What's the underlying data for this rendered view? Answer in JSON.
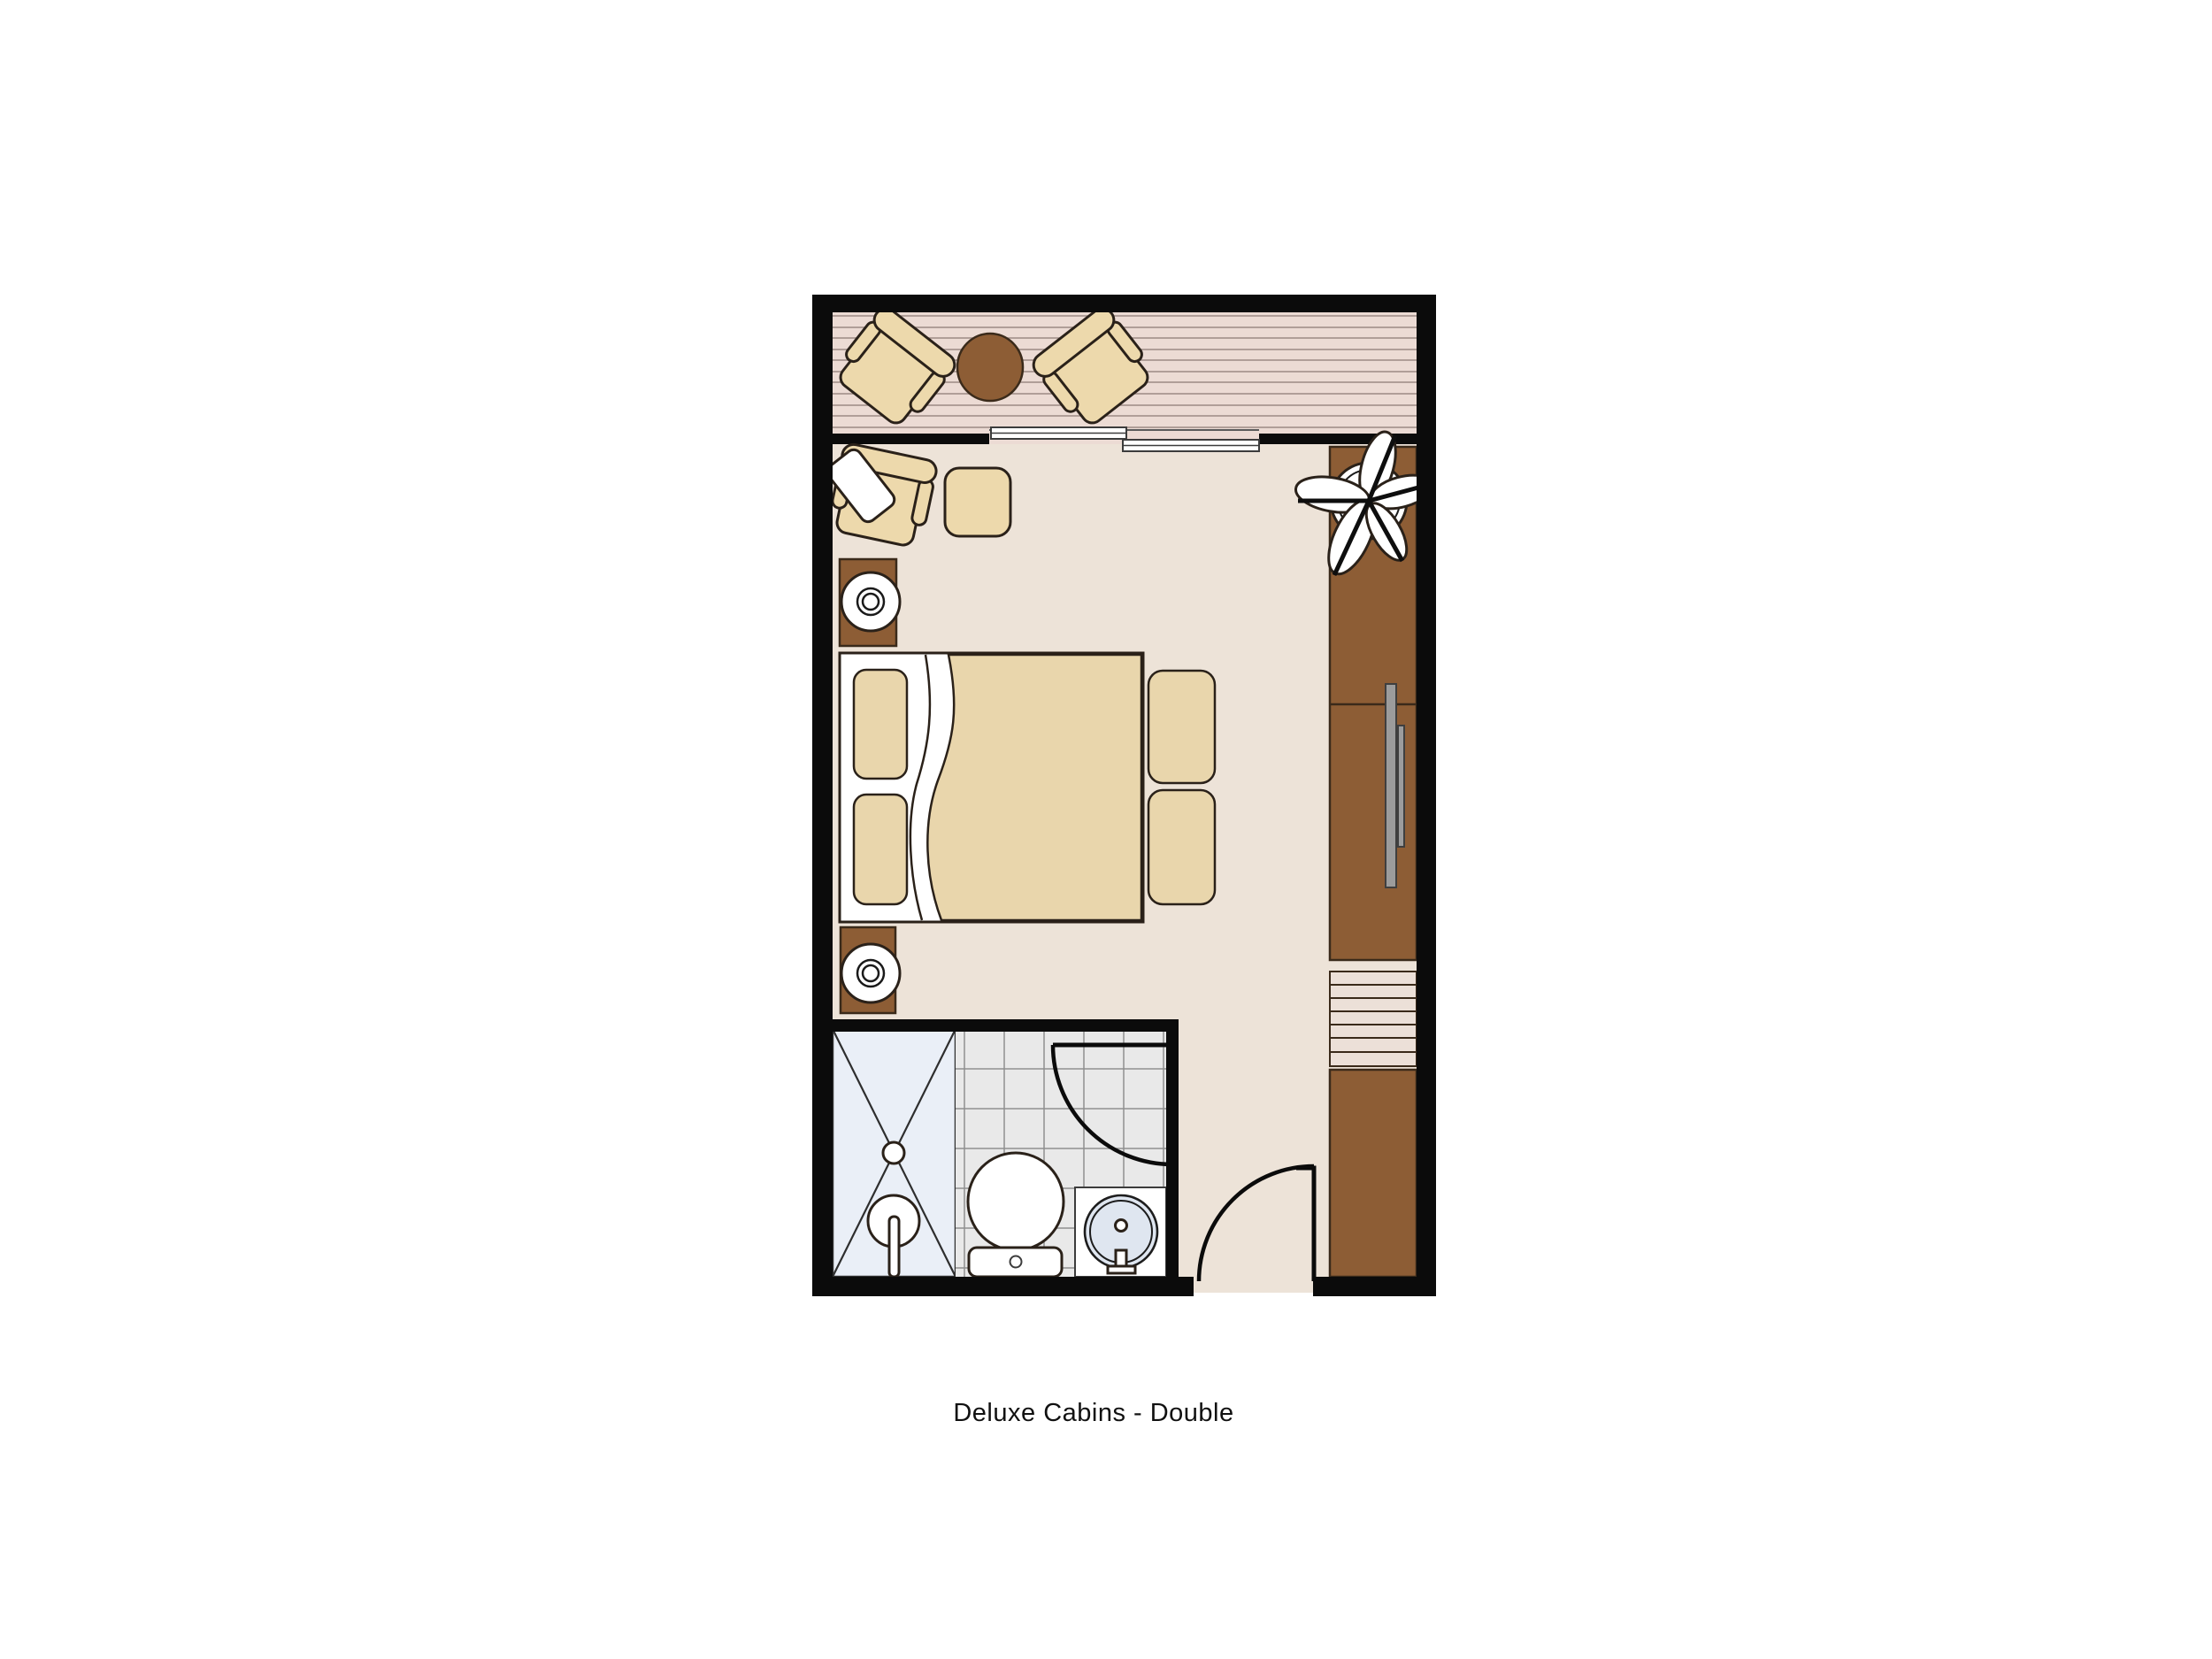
{
  "caption": {
    "text": "Deluxe Cabins - Double"
  },
  "colors": {
    "canvas_bg": "#ffffff",
    "wall": "#0b0b0b",
    "floor": "#ede3d8",
    "deck": "#ecdbd4",
    "deck_line": "#9b8a84",
    "furniture_fill": "#edd9ac",
    "furniture_outline": "#2a2119",
    "spread": "#e9d6ac",
    "wood_brown": "#8d5d35",
    "wood_outline": "#3a2a1a",
    "rack_bg": "#ece0d8",
    "fixture_white": "#ffffff",
    "shower_bg": "#eaeff7",
    "tile_bg": "#e9e9e9",
    "tile_line": "#8f8f8f",
    "basin_blue": "#dfe6f0",
    "handle_gray": "#9c9c9c",
    "caption_text": "#111111"
  },
  "plan": {
    "type": "cabin-floor-plan",
    "rooms": [
      {
        "name": "balcony"
      },
      {
        "name": "bedroom"
      },
      {
        "name": "bathroom"
      },
      {
        "name": "entry"
      }
    ],
    "furniture": [
      "balcony-chair-left",
      "balcony-table",
      "balcony-chair-right",
      "sliding-balcony-door",
      "lounge-chair",
      "pillow",
      "ottoman",
      "nightstand-top",
      "lamp",
      "double-bed",
      "pillows",
      "seat-cushion-top",
      "seat-cushion-bottom",
      "nightstand-bottom",
      "plant",
      "wardrobe",
      "wardrobe-handles",
      "luggage-rack",
      "lower-cabinet",
      "shower",
      "shower-fixture",
      "toilet",
      "sink-vanity",
      "bathroom-door",
      "entry-door"
    ]
  }
}
